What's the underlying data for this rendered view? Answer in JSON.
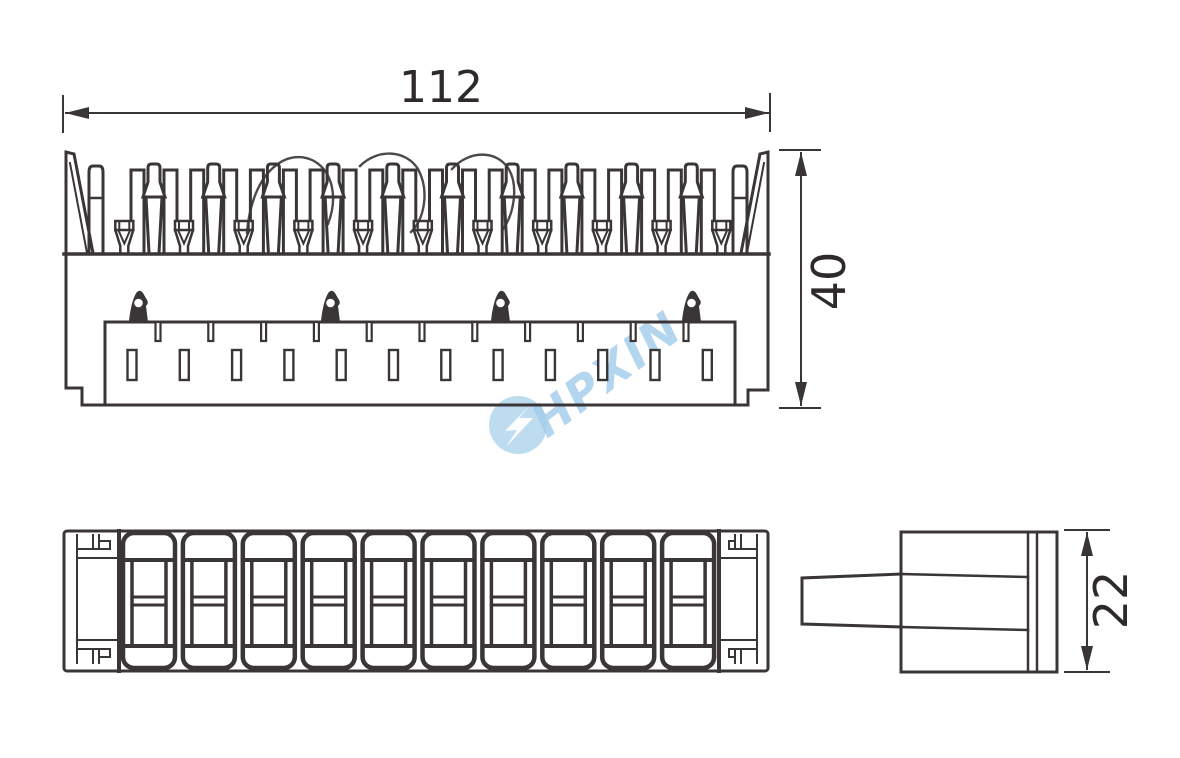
{
  "drawing": {
    "type": "technical-drawing",
    "subject": "terminal block connector, three orthographic views"
  },
  "dimensions": {
    "width": {
      "label": "112"
    },
    "height": {
      "label": "40"
    },
    "side_height": {
      "label": "22"
    }
  },
  "watermark": {
    "text": "HPXIN",
    "logo": "lightning-bolt-circle-icon",
    "color": "#6fb0de"
  },
  "colors": {
    "line": "#3a3536",
    "dim_text": "#2e2a29",
    "background": "#ffffff",
    "watermark_circle": "#5ea8da"
  },
  "views": {
    "top": {
      "tooth_count": 10,
      "funnel_count": 11,
      "hook_count": 4,
      "thin_slot_count": 11,
      "wide_slot_count": 12
    },
    "front": {
      "module_count": 10
    },
    "side": {
      "tab": true
    }
  }
}
